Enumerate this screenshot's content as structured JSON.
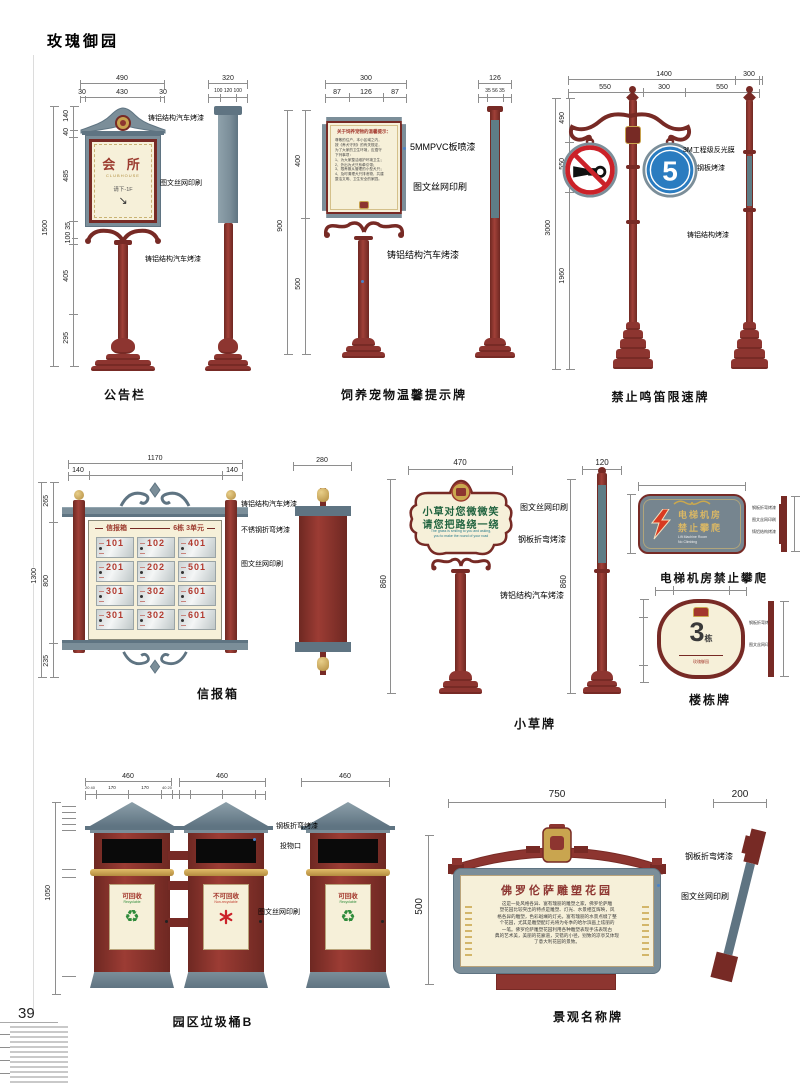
{
  "page": {
    "title": "玫瑰御园",
    "page_number": "39"
  },
  "signs": {
    "notice_board": {
      "label": "公告栏",
      "panel": {
        "title": "会 所",
        "subtitle": "CLUBHOUSE",
        "note": "请下-1F",
        "arrow": "↘"
      },
      "ann": [
        "铸铝结构汽车烤漆",
        "图文丝网印刷",
        "铸铝结构汽车烤漆"
      ],
      "dims": {
        "w": "490",
        "wp0": "30",
        "wp1": "430",
        "wp2": "30",
        "sw": "320",
        "swp": "100 120 100",
        "h": "1500",
        "s0": "140",
        "s1": "40",
        "s2": "485",
        "s3": "100 35",
        "s4": "405",
        "s5": "295"
      }
    },
    "pet_sign": {
      "label": "饲养宠物温馨提示牌",
      "panel": {
        "title": "关于饲养宠物的温馨提示：",
        "lines": [
          "尊敬的住户，本小区域之内，",
          "按《养犬守则》的有关规定，",
          "为了大家的卫生环境，应遵守",
          "下列事项：",
          "1、为大家整洁维护环境卫生；",
          "2、外出为犬只系牵引带；",
          "3、限养服从管理的小型犬只；",
          "4、及时清理犬只排泄物，共建",
          "整洁文明、卫生安全的家园。"
        ]
      },
      "ann": [
        "5MMPVC板喷漆",
        "图文丝网印刷",
        "铸铝结构汽车烤漆"
      ],
      "dims": {
        "w": "300",
        "wp0": "87",
        "wp1": "126",
        "wp2": "87",
        "sw": "126",
        "swp": "35 56 35",
        "h": "900",
        "s0": "400",
        "s1": "500"
      }
    },
    "no_horn": {
      "label": "禁止鸣笛限速牌",
      "speed": "5",
      "ann": [
        "3M工程级反光膜",
        "钢板烤漆",
        "铸铝结构烤漆"
      ],
      "dims": {
        "w": "1400",
        "wp0": "550",
        "wp1": "300",
        "wp2": "550",
        "sw": "300",
        "h": "3000",
        "s0": "490",
        "s1": "550",
        "s2": "1960"
      }
    },
    "mailbox": {
      "label": "信报箱",
      "header_left": "信报箱",
      "header_right": "6栋 3单元",
      "cells": [
        "101",
        "102",
        "401",
        "201",
        "202",
        "501",
        "301",
        "302",
        "601",
        "301",
        "302",
        "601"
      ],
      "ann": [
        "铸铝结构汽车烤漆",
        "不锈钢折弯烤漆",
        "图文丝网印刷"
      ],
      "dims": {
        "w": "1170",
        "wp0": "140",
        "wp2": "140",
        "sw": "280",
        "h": "1300",
        "s0": "265",
        "s1": "800",
        "s2": "235"
      }
    },
    "grass_sign": {
      "label": "小草牌",
      "panel": {
        "line1": "小草对您微微笑",
        "line2": "请您把路绕一绕",
        "en1": "The grass is smiling to you and asking,",
        "en2": "you to make the round of your road"
      },
      "ann": [
        "图文丝网印刷",
        "钢板折弯烤漆",
        "铸铝结构汽车烤漆"
      ],
      "dims": {
        "w": "470",
        "sw": "120",
        "h": "860",
        "h2": "860"
      }
    },
    "elevator_sign": {
      "label": "电梯机房禁止攀爬",
      "panel": {
        "line1": "电梯机房",
        "line2": "禁止攀爬",
        "en1": "Lift Machine Room",
        "en2": "No Climbing"
      },
      "ann": [
        "钢板折弯烤漆",
        "图文丝网印刷",
        "铸铝结构烤漆"
      ]
    },
    "building_sign": {
      "label": "楼栋牌",
      "panel": {
        "number": "3",
        "unit": "栋",
        "footer": "玫瑰御园"
      },
      "ann": [
        "钢板折弯烤漆",
        "图文丝网印刷"
      ]
    },
    "trash_bin": {
      "label": "园区垃圾桶B",
      "bins": [
        {
          "title": "可回收",
          "sub": "Recyclable"
        },
        {
          "title": "不可回收",
          "sub": "Non-recyclable"
        },
        {
          "title": "可回收",
          "sub": "Recyclable"
        }
      ],
      "ann": [
        "钢板折弯烤漆",
        "投物口",
        "图文丝网印刷"
      ],
      "dims": {
        "w1": "460",
        "w2": "460",
        "w3": "460",
        "h": "1050",
        "sub0": "20 40",
        "sub1": "170",
        "sub2": "170",
        "sub3": "40 20"
      }
    },
    "name_sign": {
      "label": "景观名称牌",
      "panel": {
        "title": "佛罗伦萨雕塑花园",
        "lines": [
          "这是一处风格各异、富有瑰丽的雕塑之家，佛罗伦萨雕",
          "塑花园比较突出的特点是雕塑、灯光、水景相互辉映，风",
          "格各异的雕塑，色彩斑斓的灯光，富有瑰丽的水景点缀了整",
          "个花园，尤其是雕塑配灯光将为冬季的哈尔滨画上炫丽的",
          "一笔。佛罗伦萨雕塑花园利用各种雕塑表现手法表现古",
          "典的艺术美，美丽的花廊道，交错的小径，别致的凉亭又体现",
          "了意大利花园的景致。"
        ]
      },
      "ann": [
        "钢板折弯烤漆",
        "图文丝网印刷"
      ],
      "dims": {
        "w": "750",
        "sw": "200",
        "h": "500"
      }
    }
  }
}
